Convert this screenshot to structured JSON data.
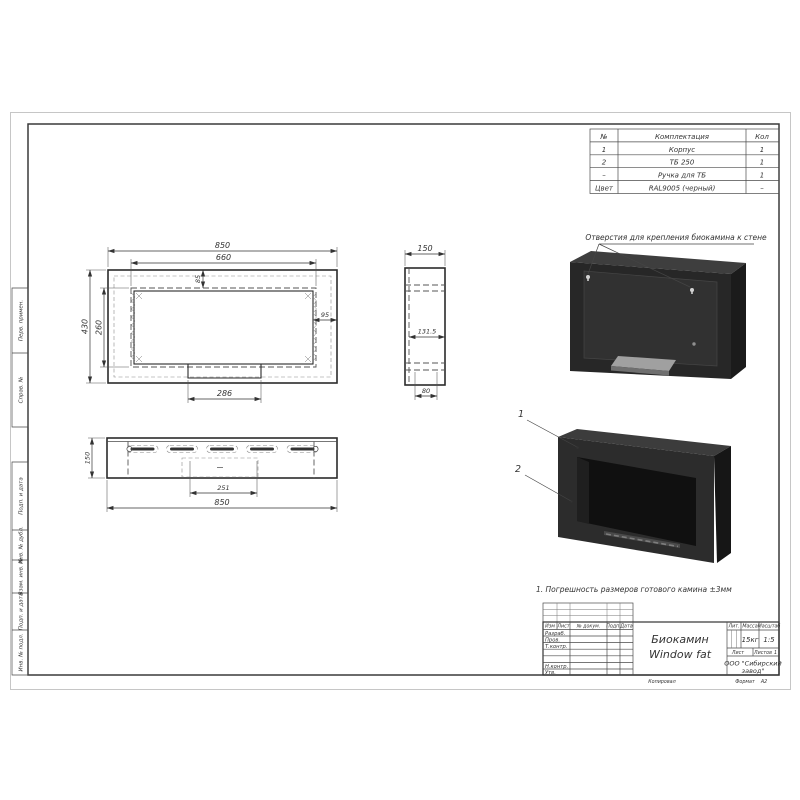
{
  "parts_table": {
    "headers": [
      "№",
      "Комплектация",
      "Кол"
    ],
    "rows": [
      [
        "1",
        "Корпус",
        "1"
      ],
      [
        "2",
        "ТБ 250",
        "1"
      ],
      [
        "–",
        "Ручка для ТБ",
        "1"
      ],
      [
        "Цвет",
        "RAL9005 (черный)",
        "–"
      ]
    ]
  },
  "dimensions": {
    "front": {
      "width": "850",
      "opening_width": "660",
      "height": "430",
      "opening_height": "260",
      "top_offset": "85",
      "side_wall": "95",
      "slot_width": "286"
    },
    "side": {
      "depth": "150",
      "inner_depth": "131.5",
      "slot_depth": "80"
    },
    "top": {
      "depth": "150",
      "tray_width": "251",
      "width": "850"
    }
  },
  "annotations": {
    "mount_note": "Отверстия для крепления биокамина к стене",
    "tolerance_note": "1. Погрешность размеров готового камина ±3мм",
    "callout_1": "1",
    "callout_2": "2"
  },
  "frame_labels": [
    "Перв. примен.",
    "Справ. №",
    "Подп. и дата",
    "Инв. № дубл.",
    "Взам. инв. №",
    "Подп. и дата",
    "Инв. № подл."
  ],
  "title_block": {
    "change_cols": [
      "Изм",
      "Лист",
      "№ докум.",
      "Подп.",
      "Дата"
    ],
    "roles": [
      "Разраб.",
      "Пров.",
      "Т.контр.",
      "Н.контр.",
      "Утв."
    ],
    "title_line1": "Биокамин",
    "title_line2": "Window fat",
    "lit_label": "Лит.",
    "mass_label": "Масса",
    "scale_label": "Масштаб",
    "mass_value": "15кг",
    "scale_value": "1:5",
    "sheet_label": "Лист",
    "sheets_label": "Листов",
    "sheets_value": "1",
    "company_line1": "ООО \"Сибирский",
    "company_line2": "завод\"",
    "copied_label": "Копировал",
    "format_label": "Формат",
    "format_value": "А2"
  },
  "colors": {
    "line": "#2b2b2b",
    "body_dark": "#262626",
    "tray_gray": "#9c9c9c"
  }
}
